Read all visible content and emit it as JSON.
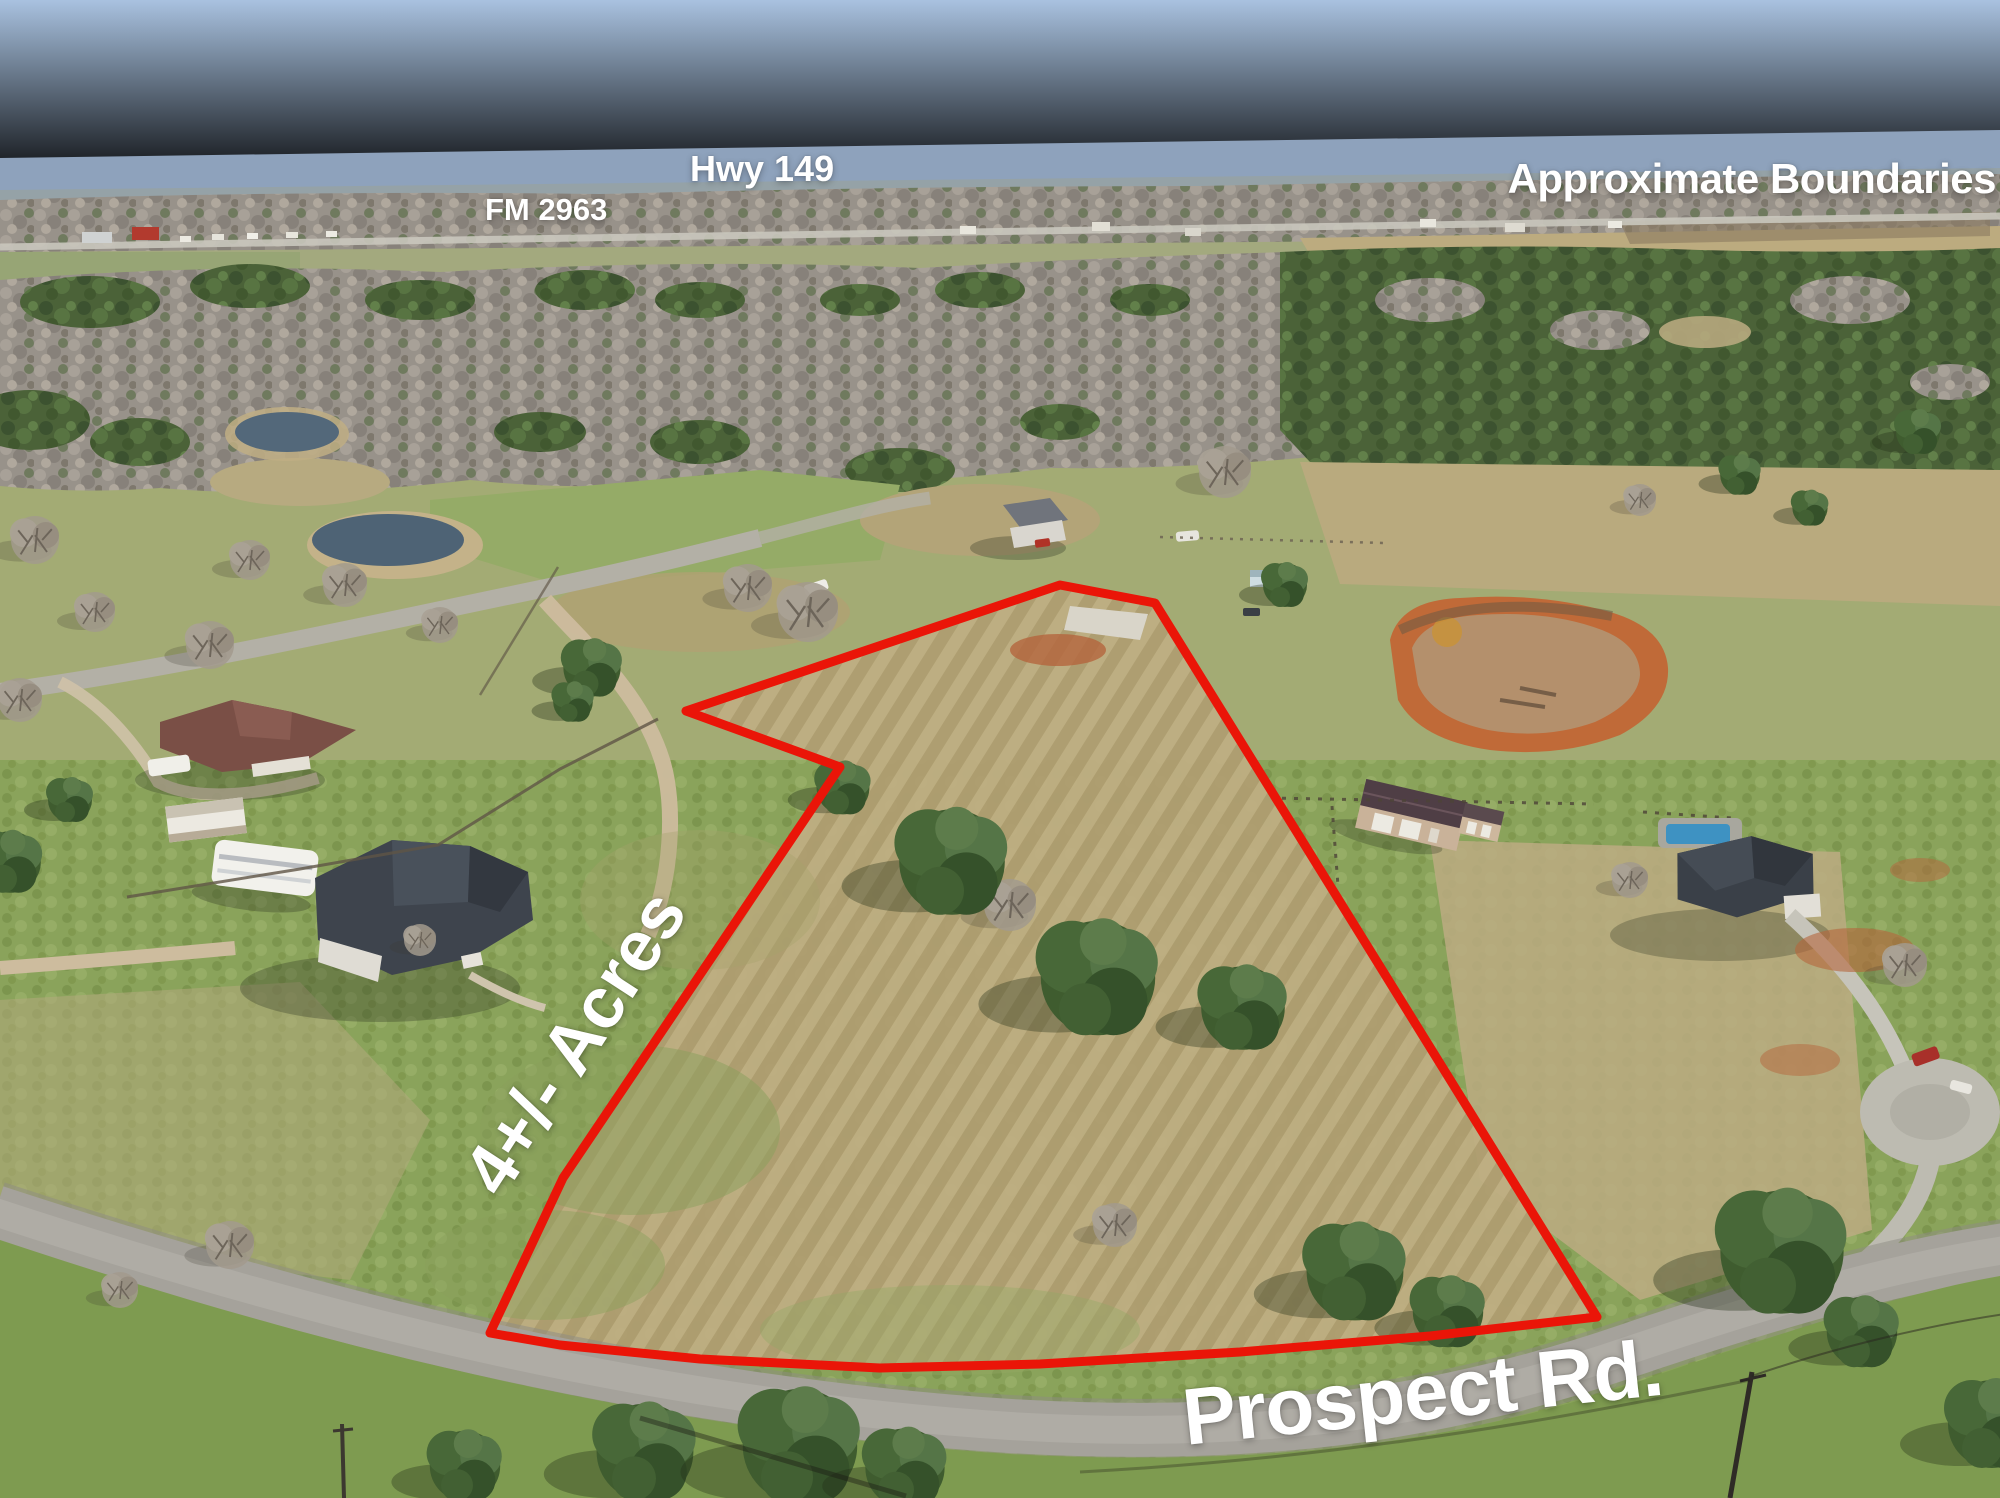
{
  "annotations": {
    "hwy": "Hwy 149",
    "fm": "FM 2963",
    "approx": "Approximate Boundaries",
    "acreage": "4+/- Acres",
    "road": "Prospect Rd.",
    "label_color": "#ffffff"
  },
  "boundary": {
    "points": "1060,585 1155,603 1597,1317 1430,1336 1240,1352 1040,1364 880,1368 700,1359 560,1345 490,1333 563,1178 840,767 686,711",
    "color": "#ea1508",
    "stroke_width": 9
  }
}
